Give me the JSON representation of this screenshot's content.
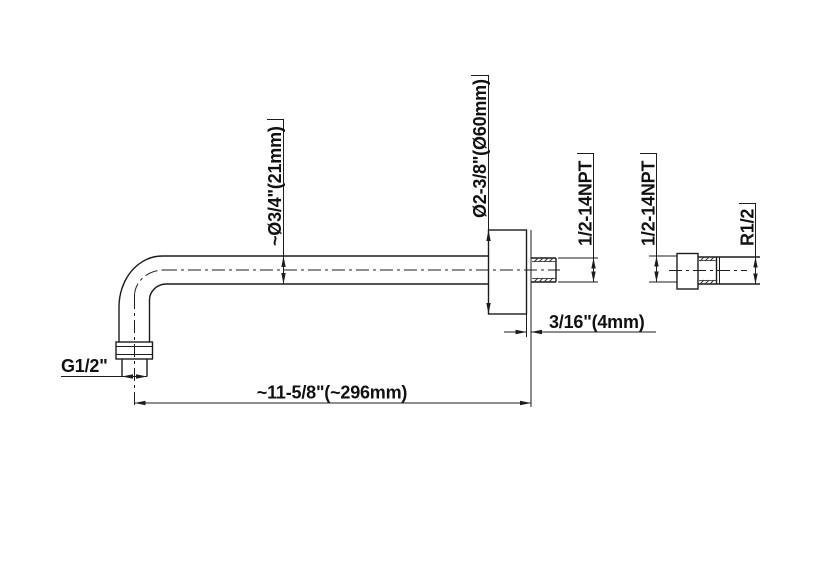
{
  "labels": {
    "arm_diameter": "~Ø3/4\"(21mm)",
    "flange_diameter": "Ø2-3/8\"(Ø60mm)",
    "wall_nipple_thread": "1/2-14NPT",
    "fitting_inlet_thread": "1/2-14NPT",
    "fitting_outlet_thread": "R1/2",
    "arm_inlet_thread": "G1/2\"",
    "flange_plate_thickness": "3/16\"(4mm)",
    "arm_length": "~11-5/8\"(~296mm)"
  },
  "colors": {
    "line": "#1c1c1c",
    "background": "#ffffff"
  }
}
